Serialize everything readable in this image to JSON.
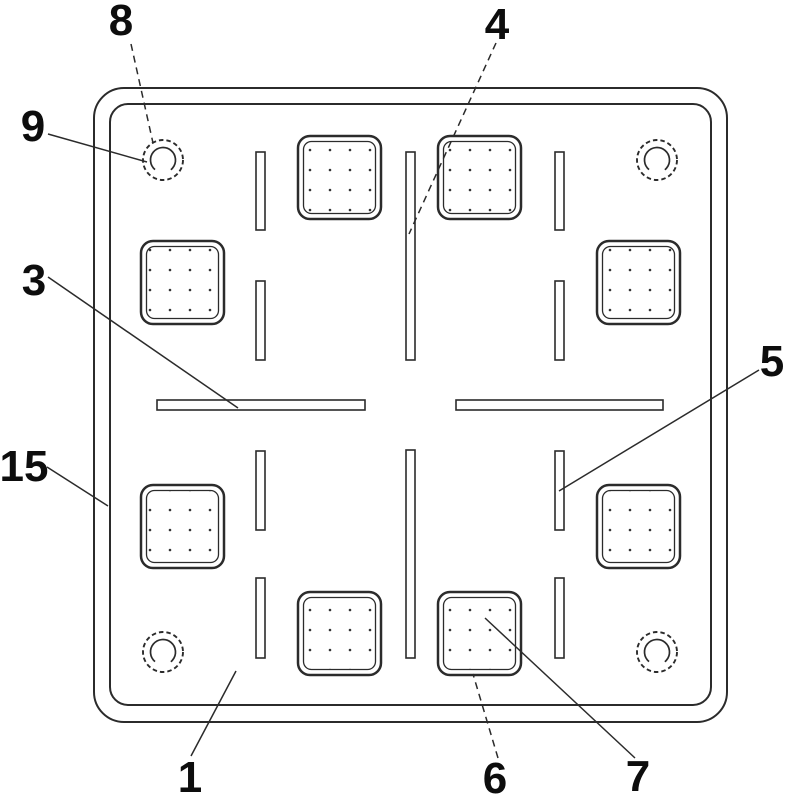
{
  "figure": {
    "kind": "patent-style technical drawing, plan view of square base plate",
    "background_color": "#ffffff",
    "line_color": "#2b2b2b",
    "label_color": "#0d0d0d",
    "labels": [
      {
        "text": "8"
      },
      {
        "text": "9"
      },
      {
        "text": "3"
      },
      {
        "text": "15"
      },
      {
        "text": "1"
      },
      {
        "text": "6"
      },
      {
        "text": "7"
      },
      {
        "text": "4"
      },
      {
        "text": "5"
      }
    ]
  }
}
